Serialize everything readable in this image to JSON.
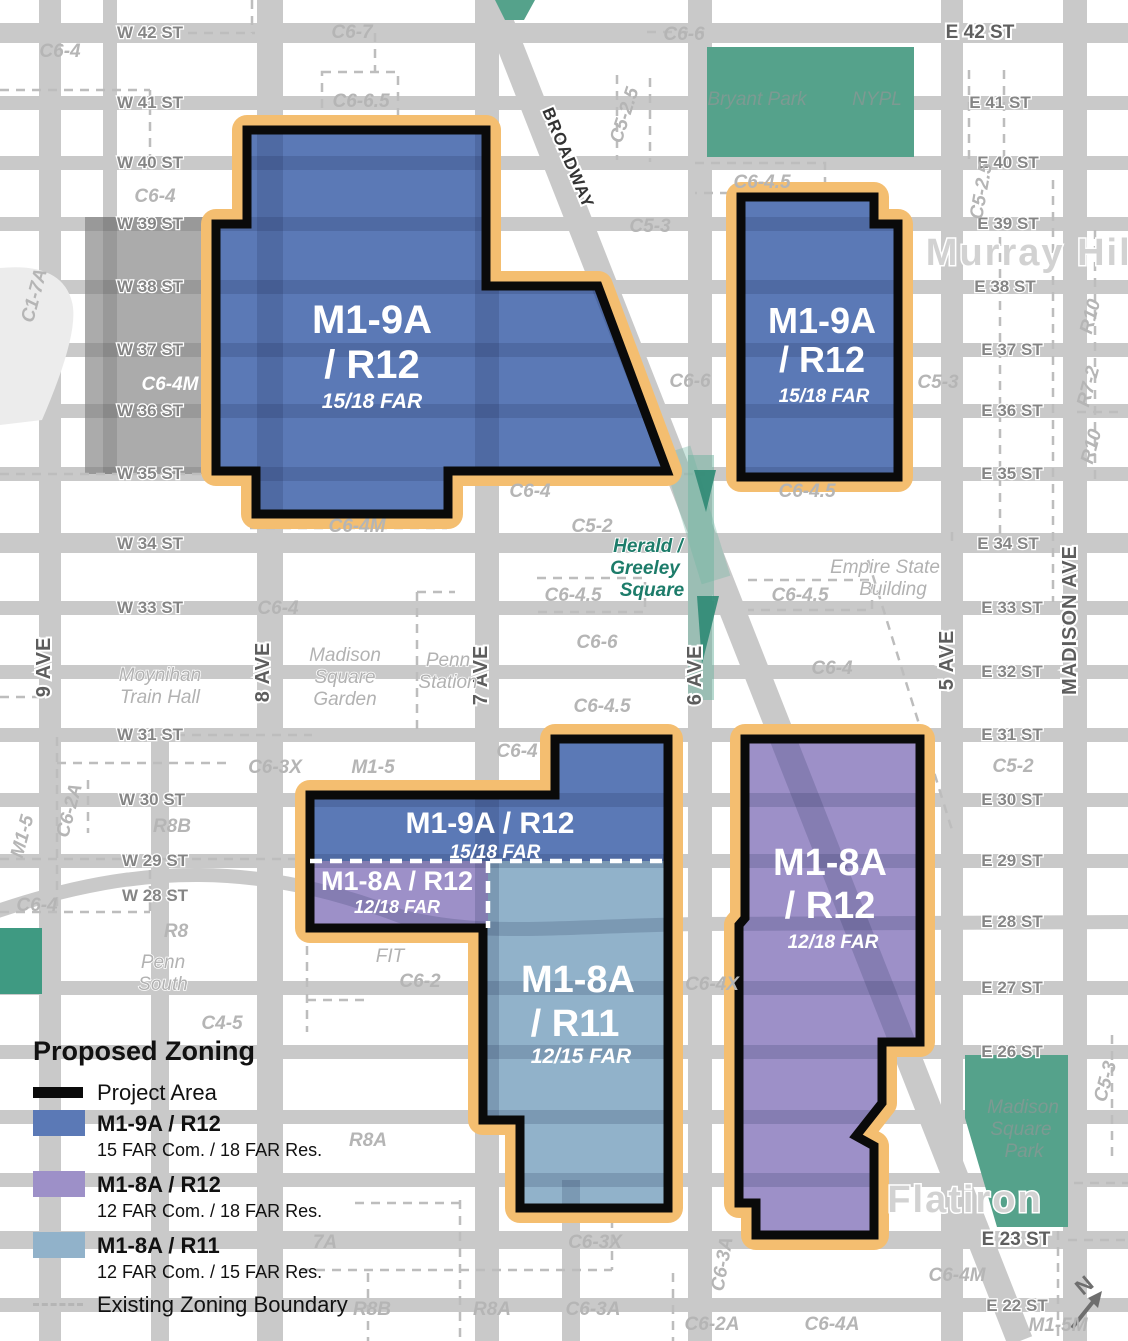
{
  "colors": {
    "street": "#c9c9c9",
    "blue": "#5b79b6",
    "purple": "#9d90c8",
    "ltblue": "#91b2ca",
    "orange": "#f4be70",
    "green": "#55a28b",
    "greendark": "#2f8a74",
    "grayzone": "#ababab"
  },
  "legend": {
    "title": "Proposed Zoning",
    "project_label": "Project Area",
    "items": [
      {
        "label": "M1-9A / R12",
        "sub": "15 FAR Com. / 18 FAR Res."
      },
      {
        "label": "M1-8A / R12",
        "sub": "12 FAR Com. / 18 FAR Res."
      },
      {
        "label": "M1-8A / R11",
        "sub": "12 FAR Com. / 15 FAR Res."
      }
    ],
    "existing_label": "Existing Zoning Boundary"
  },
  "map": {
    "labels": [
      {
        "t": "W 42 ST",
        "x": 150,
        "y": 38,
        "c": "sw"
      },
      {
        "t": "W 41 ST",
        "x": 150,
        "y": 108,
        "c": "sw"
      },
      {
        "t": "W 40 ST",
        "x": 150,
        "y": 168,
        "c": "sw"
      },
      {
        "t": "W 39 ST",
        "x": 150,
        "y": 229,
        "c": "sw"
      },
      {
        "t": "W 38 ST",
        "x": 150,
        "y": 292,
        "c": "sw"
      },
      {
        "t": "W 37 ST",
        "x": 150,
        "y": 355,
        "c": "sw"
      },
      {
        "t": "W 36 ST",
        "x": 150,
        "y": 416,
        "c": "sw"
      },
      {
        "t": "W 35 ST",
        "x": 150,
        "y": 479,
        "c": "sw"
      },
      {
        "t": "W 34 ST",
        "x": 150,
        "y": 549,
        "c": "sw"
      },
      {
        "t": "W 33 ST",
        "x": 150,
        "y": 613,
        "c": "sw"
      },
      {
        "t": "W 31 ST",
        "x": 150,
        "y": 740,
        "c": "sw"
      },
      {
        "t": "W 30 ST",
        "x": 152,
        "y": 805,
        "c": "sw"
      },
      {
        "t": "W 29 ST",
        "x": 155,
        "y": 866,
        "c": "sw"
      },
      {
        "t": "W 28 ST",
        "x": 155,
        "y": 901,
        "c": "sw"
      },
      {
        "t": "E 42 ST",
        "x": 980,
        "y": 38,
        "c": "sm"
      },
      {
        "t": "E 41 ST",
        "x": 1000,
        "y": 108,
        "c": "se"
      },
      {
        "t": "E 40 ST",
        "x": 1008,
        "y": 168,
        "c": "se"
      },
      {
        "t": "E 39 ST",
        "x": 1008,
        "y": 229,
        "c": "se"
      },
      {
        "t": "E 38 ST",
        "x": 1005,
        "y": 292,
        "c": "se"
      },
      {
        "t": "E 37 ST",
        "x": 1012,
        "y": 355,
        "c": "se"
      },
      {
        "t": "E 36 ST",
        "x": 1012,
        "y": 416,
        "c": "se"
      },
      {
        "t": "E 35 ST",
        "x": 1012,
        "y": 479,
        "c": "se"
      },
      {
        "t": "E 34 ST",
        "x": 1008,
        "y": 549,
        "c": "se"
      },
      {
        "t": "E 33 ST",
        "x": 1012,
        "y": 613,
        "c": "se"
      },
      {
        "t": "E 32 ST",
        "x": 1012,
        "y": 677,
        "c": "se"
      },
      {
        "t": "E 31 ST",
        "x": 1012,
        "y": 740,
        "c": "se"
      },
      {
        "t": "E 30 ST",
        "x": 1012,
        "y": 805,
        "c": "se"
      },
      {
        "t": "E 29 ST",
        "x": 1012,
        "y": 866,
        "c": "se"
      },
      {
        "t": "E 28 ST",
        "x": 1012,
        "y": 927,
        "c": "se"
      },
      {
        "t": "E 27 ST",
        "x": 1012,
        "y": 993,
        "c": "se"
      },
      {
        "t": "E 26 ST",
        "x": 1012,
        "y": 1057,
        "c": "se"
      },
      {
        "t": "E 23 ST",
        "x": 1016,
        "y": 1245,
        "c": "sm"
      },
      {
        "t": "E 22 ST",
        "x": 1017,
        "y": 1311,
        "c": "se"
      },
      {
        "t": "9 AVE",
        "x": 50,
        "y": 667,
        "c": "av",
        "r": -90
      },
      {
        "t": "8 AVE",
        "x": 269,
        "y": 672,
        "c": "av",
        "r": -90
      },
      {
        "t": "7 AVE",
        "x": 487,
        "y": 675,
        "c": "av",
        "r": -90
      },
      {
        "t": "6 AVE",
        "x": 701,
        "y": 675,
        "c": "av",
        "r": -90
      },
      {
        "t": "5 AVE",
        "x": 953,
        "y": 660,
        "c": "av",
        "r": -90
      },
      {
        "t": "MADISON AVE",
        "x": 1076,
        "y": 620,
        "c": "av",
        "r": -90
      },
      {
        "t": "BROADWAY",
        "x": 563,
        "y": 160,
        "c": "bw",
        "r": 67
      },
      {
        "t": "C6-4",
        "x": 60,
        "y": 57,
        "c": "zn"
      },
      {
        "t": "C6-7",
        "x": 352,
        "y": 38,
        "c": "zn"
      },
      {
        "t": "C6-6.5",
        "x": 361,
        "y": 107,
        "c": "zn"
      },
      {
        "t": "C6-6",
        "x": 684,
        "y": 40,
        "c": "zn"
      },
      {
        "t": "C6-4",
        "x": 155,
        "y": 202,
        "c": "zn"
      },
      {
        "t": "C5-3",
        "x": 650,
        "y": 232,
        "c": "zn"
      },
      {
        "t": "C6-4.5",
        "x": 762,
        "y": 188,
        "c": "zn"
      },
      {
        "t": "C6-4M",
        "x": 170,
        "y": 390,
        "c": "znw"
      },
      {
        "t": "C6-6",
        "x": 690,
        "y": 387,
        "c": "zn"
      },
      {
        "t": "C5-3",
        "x": 938,
        "y": 388,
        "c": "zn"
      },
      {
        "t": "C6-4",
        "x": 530,
        "y": 497,
        "c": "zn"
      },
      {
        "t": "C6-4.5",
        "x": 807,
        "y": 497,
        "c": "zn"
      },
      {
        "t": "C6-4M",
        "x": 357,
        "y": 532,
        "c": "zn"
      },
      {
        "t": "C5-2",
        "x": 592,
        "y": 532,
        "c": "zn"
      },
      {
        "t": "C6-4.5",
        "x": 573,
        "y": 601,
        "c": "zn"
      },
      {
        "t": "C6-4.5",
        "x": 800,
        "y": 601,
        "c": "zn"
      },
      {
        "t": "C6-6",
        "x": 597,
        "y": 648,
        "c": "zn"
      },
      {
        "t": "C6-4",
        "x": 832,
        "y": 674,
        "c": "zn"
      },
      {
        "t": "C6-4",
        "x": 278,
        "y": 614,
        "c": "zn"
      },
      {
        "t": "C6-4.5",
        "x": 602,
        "y": 712,
        "c": "zn"
      },
      {
        "t": "C6-4",
        "x": 517,
        "y": 757,
        "c": "zn"
      },
      {
        "t": "C5-2",
        "x": 1013,
        "y": 772,
        "c": "zn"
      },
      {
        "t": "C6-3X",
        "x": 275,
        "y": 773,
        "c": "zn"
      },
      {
        "t": "M1-5",
        "x": 373,
        "y": 773,
        "c": "zn"
      },
      {
        "t": "R8B",
        "x": 172,
        "y": 832,
        "c": "zn"
      },
      {
        "t": "C6-4",
        "x": 37,
        "y": 911,
        "c": "zn"
      },
      {
        "t": "R8",
        "x": 176,
        "y": 937,
        "c": "zn"
      },
      {
        "t": "C6-2",
        "x": 420,
        "y": 987,
        "c": "zn"
      },
      {
        "t": "C6-4X",
        "x": 712,
        "y": 990,
        "c": "zn"
      },
      {
        "t": "C4-5",
        "x": 222,
        "y": 1029,
        "c": "zn"
      },
      {
        "t": "R8A",
        "x": 368,
        "y": 1146,
        "c": "zn"
      },
      {
        "t": "7A",
        "x": 325,
        "y": 1248,
        "c": "zn"
      },
      {
        "t": "C6-3X",
        "x": 595,
        "y": 1248,
        "c": "zn"
      },
      {
        "t": "R8B",
        "x": 372,
        "y": 1315,
        "c": "zn"
      },
      {
        "t": "R8A",
        "x": 492,
        "y": 1315,
        "c": "zn"
      },
      {
        "t": "C6-3A",
        "x": 593,
        "y": 1315,
        "c": "zn"
      },
      {
        "t": "C6-2A",
        "x": 712,
        "y": 1330,
        "c": "zn"
      },
      {
        "t": "C6-4A",
        "x": 832,
        "y": 1330,
        "c": "zn"
      },
      {
        "t": "C6-4M",
        "x": 957,
        "y": 1281,
        "c": "zn"
      },
      {
        "t": "M1-5M",
        "x": 1058,
        "y": 1331,
        "c": "zn"
      },
      {
        "t": "C1-7A",
        "x": 40,
        "y": 297,
        "c": "zn",
        "r": -75
      },
      {
        "t": "C5-2.5",
        "x": 630,
        "y": 117,
        "c": "zn",
        "r": -72
      },
      {
        "t": "C5-2.5",
        "x": 987,
        "y": 192,
        "c": "zn",
        "r": -80
      },
      {
        "t": "C6-2A",
        "x": 75,
        "y": 812,
        "c": "zn",
        "r": -75
      },
      {
        "t": "M1-5",
        "x": 28,
        "y": 838,
        "c": "zn",
        "r": -75
      },
      {
        "t": "R10",
        "x": 1096,
        "y": 318,
        "c": "zn",
        "r": -75
      },
      {
        "t": "R7-2",
        "x": 1094,
        "y": 388,
        "c": "zn",
        "r": -75
      },
      {
        "t": "R10",
        "x": 1097,
        "y": 448,
        "c": "zn",
        "r": -75
      },
      {
        "t": "C6-3A",
        "x": 728,
        "y": 1265,
        "c": "zn",
        "r": -80
      },
      {
        "t": "C5-3",
        "x": 1111,
        "y": 1083,
        "c": "zn",
        "r": -75
      },
      {
        "t": "Bryant Park",
        "x": 757,
        "y": 105,
        "c": "pk"
      },
      {
        "t": "NYPL",
        "x": 877,
        "y": 105,
        "c": "pk"
      },
      {
        "t": "Empire State",
        "x": 885,
        "y": 573,
        "c": "pl"
      },
      {
        "t": "Building",
        "x": 893,
        "y": 595,
        "c": "pl"
      },
      {
        "t": "Herald /",
        "x": 648,
        "y": 552,
        "c": "tl"
      },
      {
        "t": "Greeley",
        "x": 645,
        "y": 574,
        "c": "tl"
      },
      {
        "t": "Square",
        "x": 652,
        "y": 596,
        "c": "tl"
      },
      {
        "t": "Moynihan",
        "x": 160,
        "y": 681,
        "c": "pl"
      },
      {
        "t": "Train Hall",
        "x": 160,
        "y": 703,
        "c": "pl"
      },
      {
        "t": "Madison",
        "x": 345,
        "y": 661,
        "c": "pl"
      },
      {
        "t": "Square",
        "x": 345,
        "y": 683,
        "c": "pl"
      },
      {
        "t": "Garden",
        "x": 345,
        "y": 705,
        "c": "pl"
      },
      {
        "t": "Penn",
        "x": 448,
        "y": 666,
        "c": "pl"
      },
      {
        "t": "Station",
        "x": 448,
        "y": 688,
        "c": "pl"
      },
      {
        "t": "Penn",
        "x": 163,
        "y": 968,
        "c": "pl"
      },
      {
        "t": "South",
        "x": 163,
        "y": 990,
        "c": "pl"
      },
      {
        "t": "FIT",
        "x": 390,
        "y": 962,
        "c": "pl"
      },
      {
        "t": "Madison",
        "x": 1023,
        "y": 1113,
        "c": "pk"
      },
      {
        "t": "Square",
        "x": 1021,
        "y": 1135,
        "c": "pk"
      },
      {
        "t": "Park",
        "x": 1024,
        "y": 1157,
        "c": "pk"
      },
      {
        "t": "Murray Hill",
        "x": 1035,
        "y": 265,
        "c": "hd"
      },
      {
        "t": "Flatiron",
        "x": 965,
        "y": 1212,
        "c": "hd"
      },
      {
        "t": "M1-9A",
        "x": 372,
        "y": 333,
        "c": "zb",
        "s": 40
      },
      {
        "t": "/ R12",
        "x": 372,
        "y": 378,
        "c": "zb",
        "s": 40
      },
      {
        "t": "15/18 FAR",
        "x": 372,
        "y": 408,
        "c": "zf",
        "s": 21
      },
      {
        "t": "M1-9A",
        "x": 822,
        "y": 333,
        "c": "zb",
        "s": 36
      },
      {
        "t": "/ R12",
        "x": 822,
        "y": 372,
        "c": "zb",
        "s": 36
      },
      {
        "t": "15/18 FAR",
        "x": 824,
        "y": 402,
        "c": "zf",
        "s": 19
      },
      {
        "t": "M1-9A / R12",
        "x": 490,
        "y": 833,
        "c": "zb",
        "s": 30
      },
      {
        "t": "15/18 FAR",
        "x": 495,
        "y": 858,
        "c": "zf",
        "s": 19
      },
      {
        "t": "M1-8A / R12",
        "x": 397,
        "y": 890,
        "c": "zb",
        "s": 27
      },
      {
        "t": "12/18 FAR",
        "x": 397,
        "y": 913,
        "c": "zf",
        "s": 18
      },
      {
        "t": "M1-8A",
        "x": 578,
        "y": 992,
        "c": "zb",
        "s": 38
      },
      {
        "t": "/ R11",
        "x": 575,
        "y": 1036,
        "c": "zb",
        "s": 38
      },
      {
        "t": "12/15 FAR",
        "x": 581,
        "y": 1063,
        "c": "zf",
        "s": 21
      },
      {
        "t": "M1-8A",
        "x": 830,
        "y": 875,
        "c": "zb",
        "s": 38
      },
      {
        "t": "/ R12",
        "x": 830,
        "y": 918,
        "c": "zb",
        "s": 38
      },
      {
        "t": "12/18 FAR",
        "x": 833,
        "y": 948,
        "c": "zf",
        "s": 19
      },
      {
        "t": "N",
        "x": 1089,
        "y": 1291,
        "c": "no",
        "r": -40
      }
    ]
  }
}
